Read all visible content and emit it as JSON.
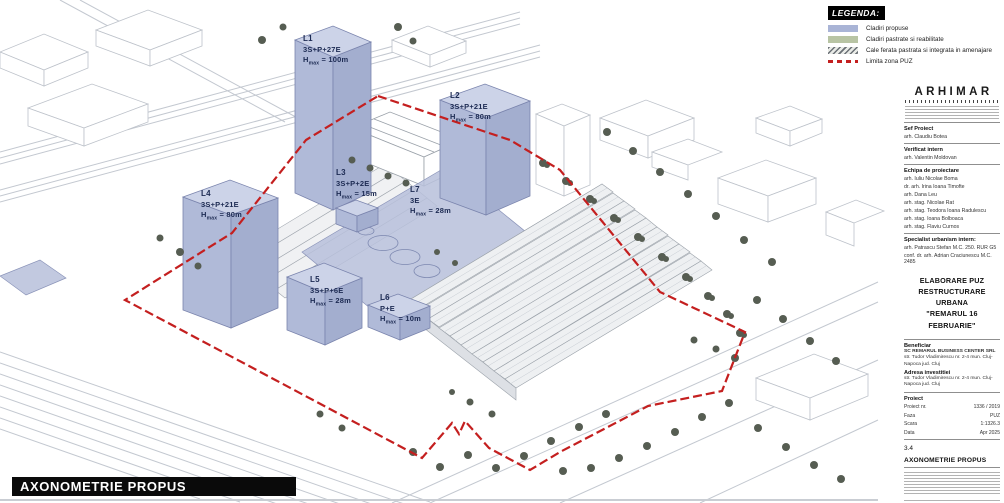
{
  "legend": {
    "title": "LEGENDA:",
    "items": [
      {
        "label": "Cladiri propuse",
        "color": "#a9b4d6",
        "pattern": "fill"
      },
      {
        "label": "Cladiri pastrate si reabilitate",
        "color": "#b8c4a4",
        "pattern": "fill"
      },
      {
        "label": "Cale ferata pastrata si integrata in amenajare",
        "color": "#6a7076",
        "pattern": "hatch"
      },
      {
        "label": "Limita zona PUZ",
        "color": "#c41f1f",
        "pattern": "dash"
      }
    ]
  },
  "buildings": {
    "l1": {
      "id": "L1",
      "regime": "3S+P+27E",
      "h": "H",
      "h_sub": "max",
      "h_val": " = 100m"
    },
    "l2": {
      "id": "L2",
      "regime": "3S+P+21E",
      "h": "H",
      "h_sub": "max",
      "h_val": " = 80m"
    },
    "l3": {
      "id": "L3",
      "regime": "3S+P+2E",
      "h": "H",
      "h_sub": "max",
      "h_val": " = 15m"
    },
    "l4": {
      "id": "L4",
      "regime": "3S+P+21E",
      "h": "H",
      "h_sub": "max",
      "h_val": " = 80m"
    },
    "l5": {
      "id": "L5",
      "regime": "3S+P+6E",
      "h": "H",
      "h_sub": "max",
      "h_val": " = 28m"
    },
    "l6": {
      "id": "L6",
      "regime": "P+E",
      "h": "H",
      "h_sub": "max",
      "h_val": " = 10m"
    },
    "l7": {
      "id": "L7",
      "regime": "3E",
      "h": "H",
      "h_sub": "max",
      "h_val": " = 28m"
    }
  },
  "title_bar": {
    "label": "AXONOMETRIE PROPUS"
  },
  "colors": {
    "proposed_building": "#a9b4d6",
    "boundary_red": "#c41f1f",
    "tree_green": "#565d52"
  },
  "panel": {
    "logo": "ARHIMAR",
    "sections": {
      "sef_proiect": {
        "heading": "Sef Proiect",
        "names": [
          "arh. Claudiu Botea"
        ]
      },
      "verificat": {
        "heading": "Verificat intern",
        "names": [
          "arh. Valentin Moldovan"
        ]
      },
      "echipa": {
        "heading": "Echipa de proiectare",
        "names": [
          "arh. Iuliu Nicolae Boma",
          "dr. arh. Irina Ioana Timofte",
          "arh. Dana Leu",
          "arh. stag. Nicolae Rat",
          "arh. stag. Teodora Ioana Radulescu",
          "arh. stag. Ioana Bolboaca",
          "arh. stag. Flaviu Curnos"
        ]
      },
      "specialist": {
        "heading": "Specialist urbanism intern:",
        "names": [
          "arh. Patrascu Stefan M.C. 250. RUR G5",
          "conf. dr. arh. Adrian Craciunescu M.C. 2485"
        ]
      }
    },
    "project_title": [
      "ELABORARE PUZ",
      "RESTRUCTURARE URBANA",
      "\"REMARUL 16 FEBRUARIE\""
    ],
    "beneficiar": {
      "heading": "Beneficiar",
      "company": "SC REMARUL BUSINESS CENTER SRL",
      "address": "str. Tudor Vladimirescu nr. 2-4 mun. Cluj-Napoca jud. Cluj"
    },
    "adresa": {
      "heading": "Adresa investitiei",
      "address": "str. Tudor Vladimirescu nr. 2-4 mun. Cluj-Napoca jud. Cluj"
    },
    "proiect": {
      "heading": "Proiect",
      "rows": [
        {
          "label": "Proiect nr.",
          "value": "1336 / 2019"
        },
        {
          "label": "Faza",
          "value": "PUZ"
        },
        {
          "label": "Scara",
          "value": "1:1326.3"
        },
        {
          "label": "Data",
          "value": "Apr 2025"
        }
      ]
    },
    "sheet": {
      "number": "3.4",
      "title": "AXONOMETRIE PROPUS"
    }
  }
}
